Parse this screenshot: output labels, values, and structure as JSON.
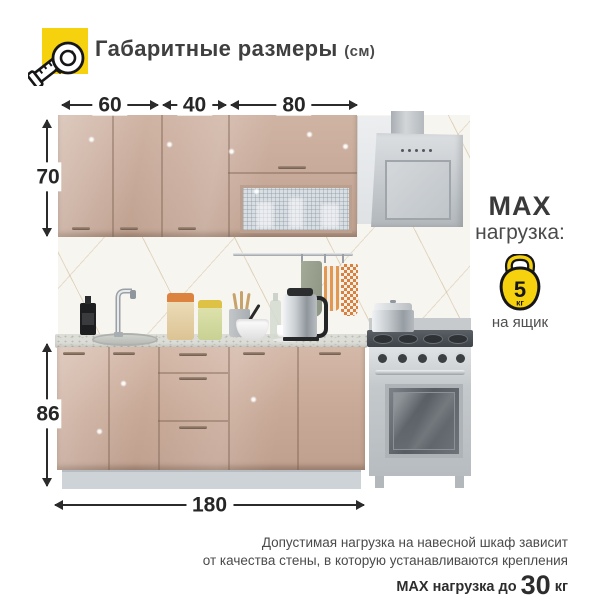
{
  "header": {
    "title": "Габаритные размеры",
    "unit": "(см)"
  },
  "dimensions": {
    "top_widths": [
      "60",
      "40",
      "80"
    ],
    "upper_cabinet_height": "70",
    "base_cabinet_height": "86",
    "total_width": "180"
  },
  "max_load_badge": {
    "line1": "MAX",
    "line2": "нагрузка:",
    "weight": "5",
    "weight_unit": "кг",
    "scope": "на ящик"
  },
  "footnote": {
    "line1": "Допустимая нагрузка на навесной шкаф зависит",
    "line2": "от качества стены, в которую устанавливаются крепления",
    "max_label": "MAX нагрузка до",
    "max_value": "30",
    "max_unit": "кг"
  },
  "colors": {
    "accent_yellow": "#F5D20D",
    "cabinet_mocha": "#C9AC9B",
    "countertop_grey": "#DCDDD7",
    "steel_grey": "#C6CACD",
    "text_dark": "#3A3A3A"
  }
}
